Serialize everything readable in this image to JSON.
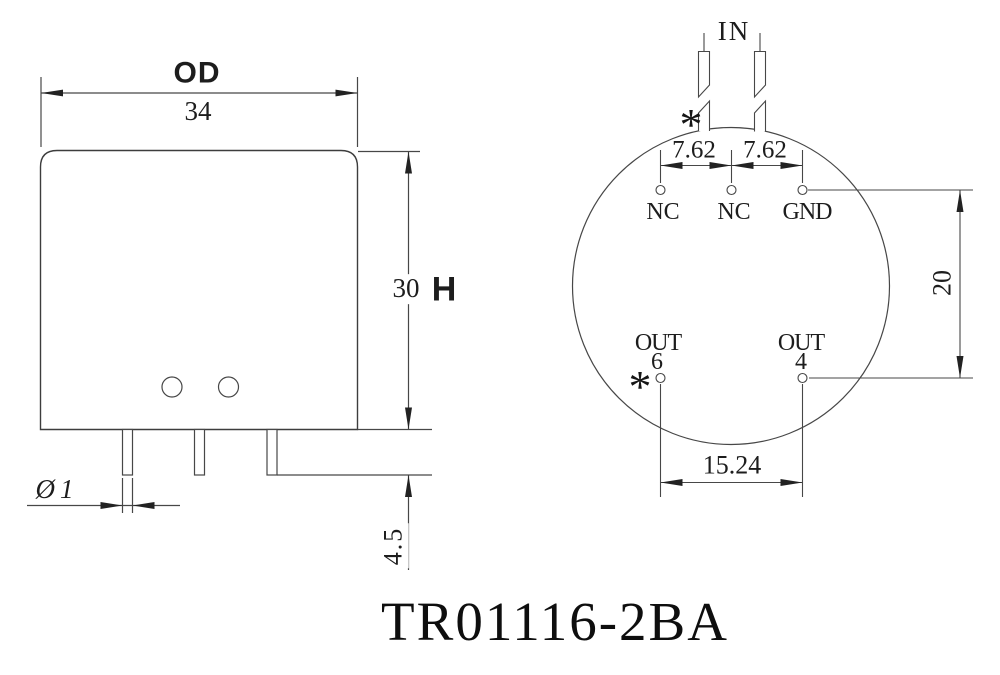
{
  "title": "TR01116-2BA",
  "front_view": {
    "outer_diameter_label": "OD",
    "outer_diameter_value": "34",
    "height_value": "30",
    "height_label": "H",
    "pin_diameter": "Ø1",
    "pin_length": "4.5"
  },
  "bottom_view": {
    "input_label": "IN",
    "start_marker_top": "*",
    "start_marker_bottom": "*",
    "pitch_left": "7.62",
    "pitch_right": "7.62",
    "row_spacing": "20",
    "output_pitch": "15.24",
    "top_pins": [
      {
        "name": "NC"
      },
      {
        "name": "NC"
      },
      {
        "name": "GND"
      }
    ],
    "bottom_pins": [
      {
        "name": "OUT",
        "number": "6"
      },
      {
        "name": "OUT",
        "number": "4"
      }
    ]
  }
}
